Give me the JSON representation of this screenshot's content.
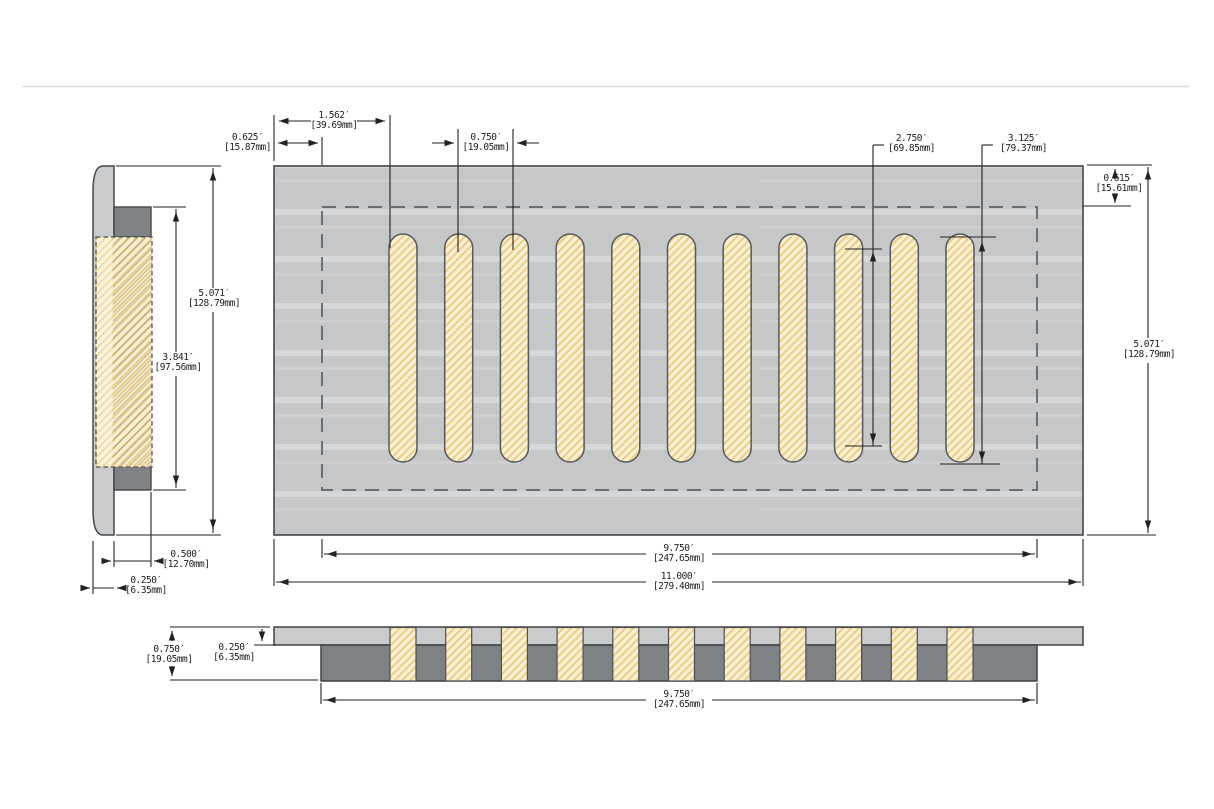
{
  "drawing": {
    "kind": "dimensioned technical drawing",
    "subject": "louvered vent register plate - top, side and section views",
    "slot_count": 11,
    "views": [
      "side-profile-view",
      "top-plan-view",
      "bottom-section-view"
    ]
  },
  "colors": {
    "plate_gray": "#c5c7c9",
    "body_dark_gray": "#7f8285",
    "slot_cream": "#faf0d2",
    "hatch_line": "#ecca82",
    "outline": "#43474b",
    "dimension_ink": "#222222"
  },
  "dims": {
    "slot_offset": {
      "in": "1.562′",
      "mm": "[39.69mm]"
    },
    "left_margin": {
      "in": "0.625′",
      "mm": "[15.87mm]"
    },
    "slot_pitch": {
      "in": "0.750′",
      "mm": "[19.05mm]"
    },
    "slot_straight": {
      "in": "2.750′",
      "mm": "[69.85mm]"
    },
    "slot_overall": {
      "in": "3.125′",
      "mm": "[79.37mm]"
    },
    "top_margin": {
      "in": "0.615′",
      "mm": "[15.61mm]"
    },
    "plate_height_right": {
      "in": "5.071′",
      "mm": "[128.79mm]"
    },
    "opening_width_top": {
      "in": "9.750′",
      "mm": "[247.65mm]"
    },
    "plate_width": {
      "in": "11.000′",
      "mm": "[279.40mm]"
    },
    "side_height": {
      "in": "5.071′",
      "mm": "[128.79mm]"
    },
    "side_opening": {
      "in": "3.841′",
      "mm": "[97.56mm]"
    },
    "side_depth": {
      "in": "0.500′",
      "mm": "[12.70mm]"
    },
    "side_plate_thk": {
      "in": "0.250′",
      "mm": "[6.35mm]"
    },
    "section_height": {
      "in": "0.750′",
      "mm": "[19.05mm]"
    },
    "section_plate_thk": {
      "in": "0.250′",
      "mm": "[6.35mm]"
    },
    "section_opening": {
      "in": "9.750′",
      "mm": "[247.65mm]"
    }
  }
}
